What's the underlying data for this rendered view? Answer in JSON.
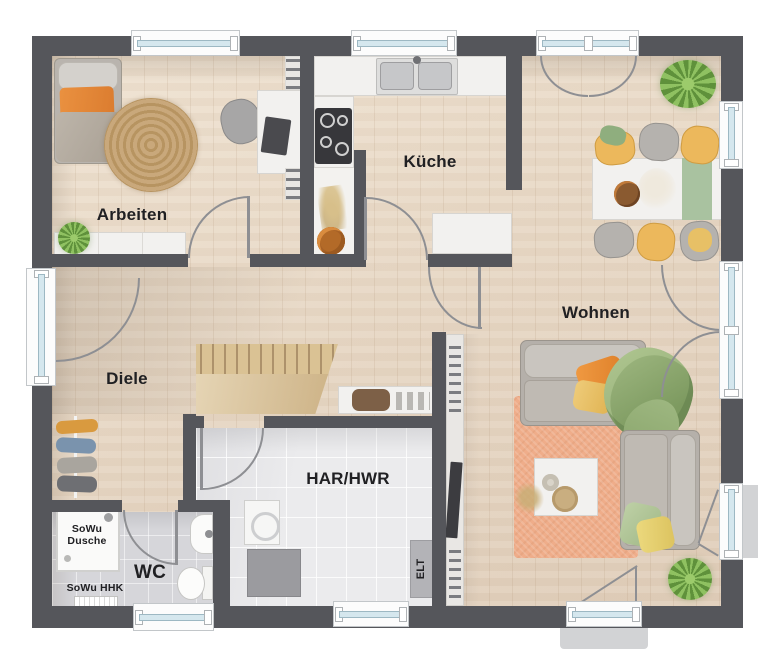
{
  "labels": {
    "arbeiten": "Arbeiten",
    "kueche": "Küche",
    "wohnen": "Wohnen",
    "diele": "Diele",
    "har_hwr": "HAR/HWR",
    "wc": "WC",
    "shower_line1": "SoWu",
    "shower_line2": "Dusche",
    "heater": "SoWu HHK",
    "elt": "ELT"
  },
  "colors": {
    "wall": "#55565b",
    "wood_floor": "#e8dac8",
    "tile_wc": "#d6d6da",
    "tile_har": "#ebebed",
    "window_glass": "#d5e7ee",
    "accent_orange": "#e08633",
    "accent_yellow": "#e7c066",
    "accent_green": "#9cb57e",
    "rug_salmon": "#efad8a",
    "rug_jute": "#c2a377",
    "plant_green": "#6b9c42"
  }
}
